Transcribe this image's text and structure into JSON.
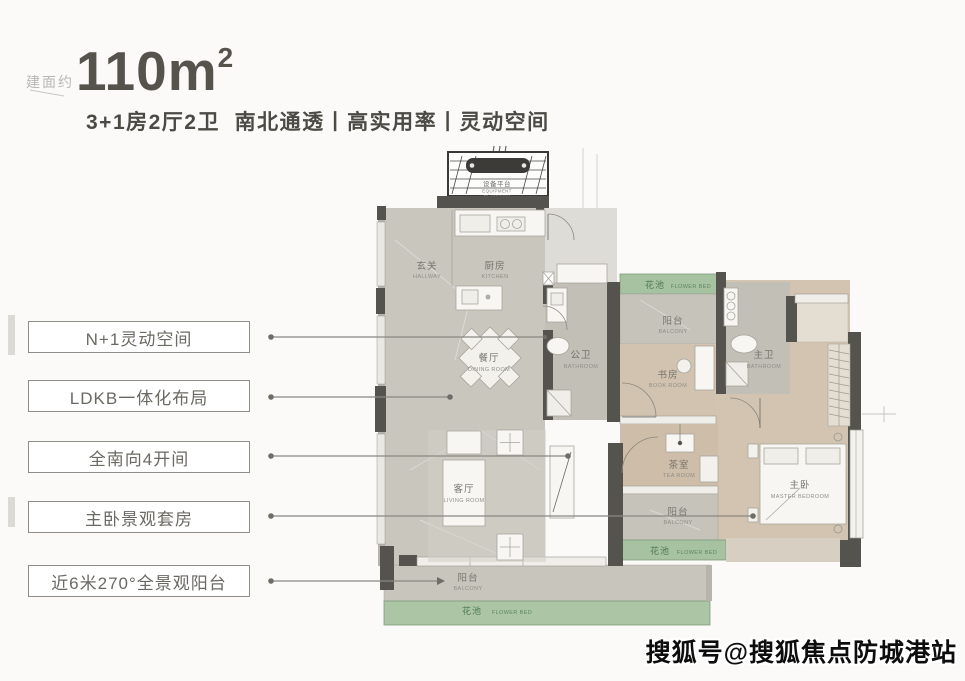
{
  "header": {
    "area_prefix": "建面约",
    "area_value": "110m",
    "area_exponent": "2",
    "tagline": "3+1房2厅2卫  南北通透丨高实用率丨灵动空间"
  },
  "features": [
    {
      "label": "N+1灵动空间"
    },
    {
      "label": "LDKB一体化布局"
    },
    {
      "label": "全南向4开间"
    },
    {
      "label": "主卧景观套房"
    },
    {
      "label": "近6米270°全景观阳台"
    }
  ],
  "plan": {
    "rooms": {
      "equipment": {
        "zh": "设备平台",
        "en1": "EQUIPMENT",
        "en2": "PLATFORM"
      },
      "hallway": {
        "zh": "玄关",
        "en": "HALLWAY"
      },
      "kitchen": {
        "zh": "厨房",
        "en": "KITCHEN"
      },
      "dining": {
        "zh": "餐厅",
        "en": "DINING ROOM"
      },
      "living": {
        "zh": "客厅",
        "en": "LIVING ROOM"
      },
      "guest_bath": {
        "zh": "公卫",
        "en": "BATHROOM"
      },
      "balcony_top": {
        "zh": "阳台",
        "en": "BALCONY"
      },
      "book": {
        "zh": "书房",
        "en": "BOOK ROOM"
      },
      "master_bath": {
        "zh": "主卫",
        "en": "BATHROOM"
      },
      "tea": {
        "zh": "茶室",
        "en": "TEA ROOM"
      },
      "balcony_mid": {
        "zh": "阳台",
        "en": "BALCONY"
      },
      "master": {
        "zh": "主卧",
        "en": "MASTER BEDROOM"
      },
      "balcony_bottom": {
        "zh": "阳台",
        "en": "BALCONY"
      },
      "flower_top": {
        "zh": "花池",
        "en": "FLOWER BED"
      },
      "flower_right": {
        "zh": "花池",
        "en": "FLOWER BED"
      },
      "flower_bottom": {
        "zh": "花池",
        "en": "FLOWER BED"
      }
    },
    "colors": {
      "wall": "#54534e",
      "marble": "#c9c6be",
      "wood": "#d3c4b1",
      "flower_bed": "#a7c2a1",
      "flower_text": "#4e7a50"
    }
  },
  "watermark": {
    "text": "搜狐号@搜狐焦点防城港站"
  }
}
